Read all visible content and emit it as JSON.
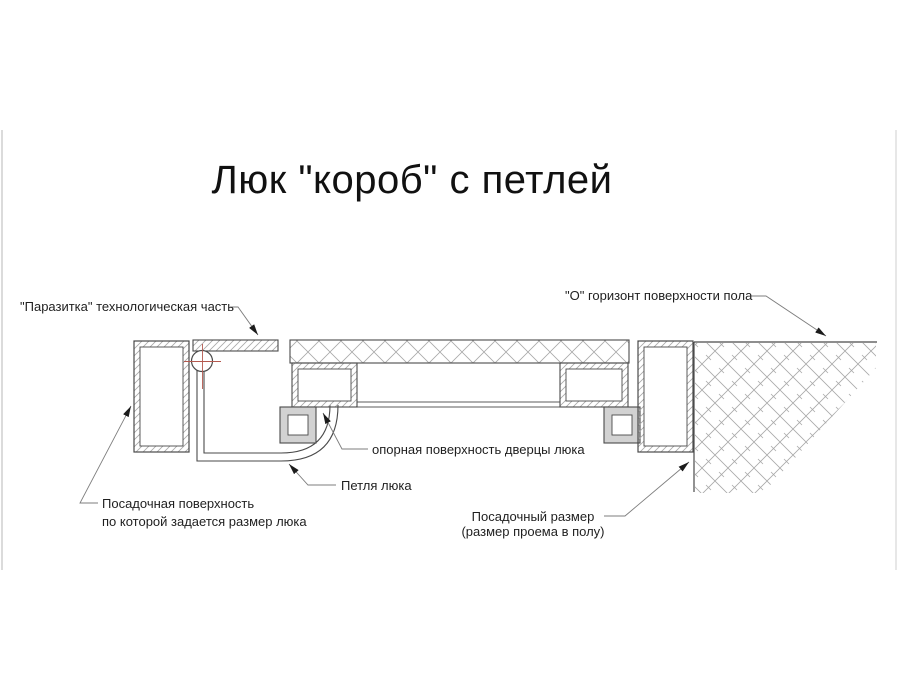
{
  "title": "Люк \"короб\" с петлей",
  "diagram": {
    "labels": {
      "parasitka": "\"Паразитка\" технологическая часть",
      "floor_horizon": "\"О\" горизонт поверхности пола",
      "door_support_surface": "опорная поверхность дверцы люка",
      "hinge": "Петля люка",
      "seating_surface_line1": "Посадочная поверхность",
      "seating_surface_line2": "по которой задается размер люка",
      "seating_size_line1": "Посадочный размер",
      "seating_size_line2": "(размер проема в полу)"
    },
    "colors": {
      "outline": "#4a4a4a",
      "hatch": "#a9a9a9",
      "leader": "#7d7d7d",
      "arrow": "#1c1c1c",
      "centerline_red": "#b4594f",
      "seal_fill": "#d2d2d2",
      "photo_edge": "#cfcfcf"
    }
  }
}
